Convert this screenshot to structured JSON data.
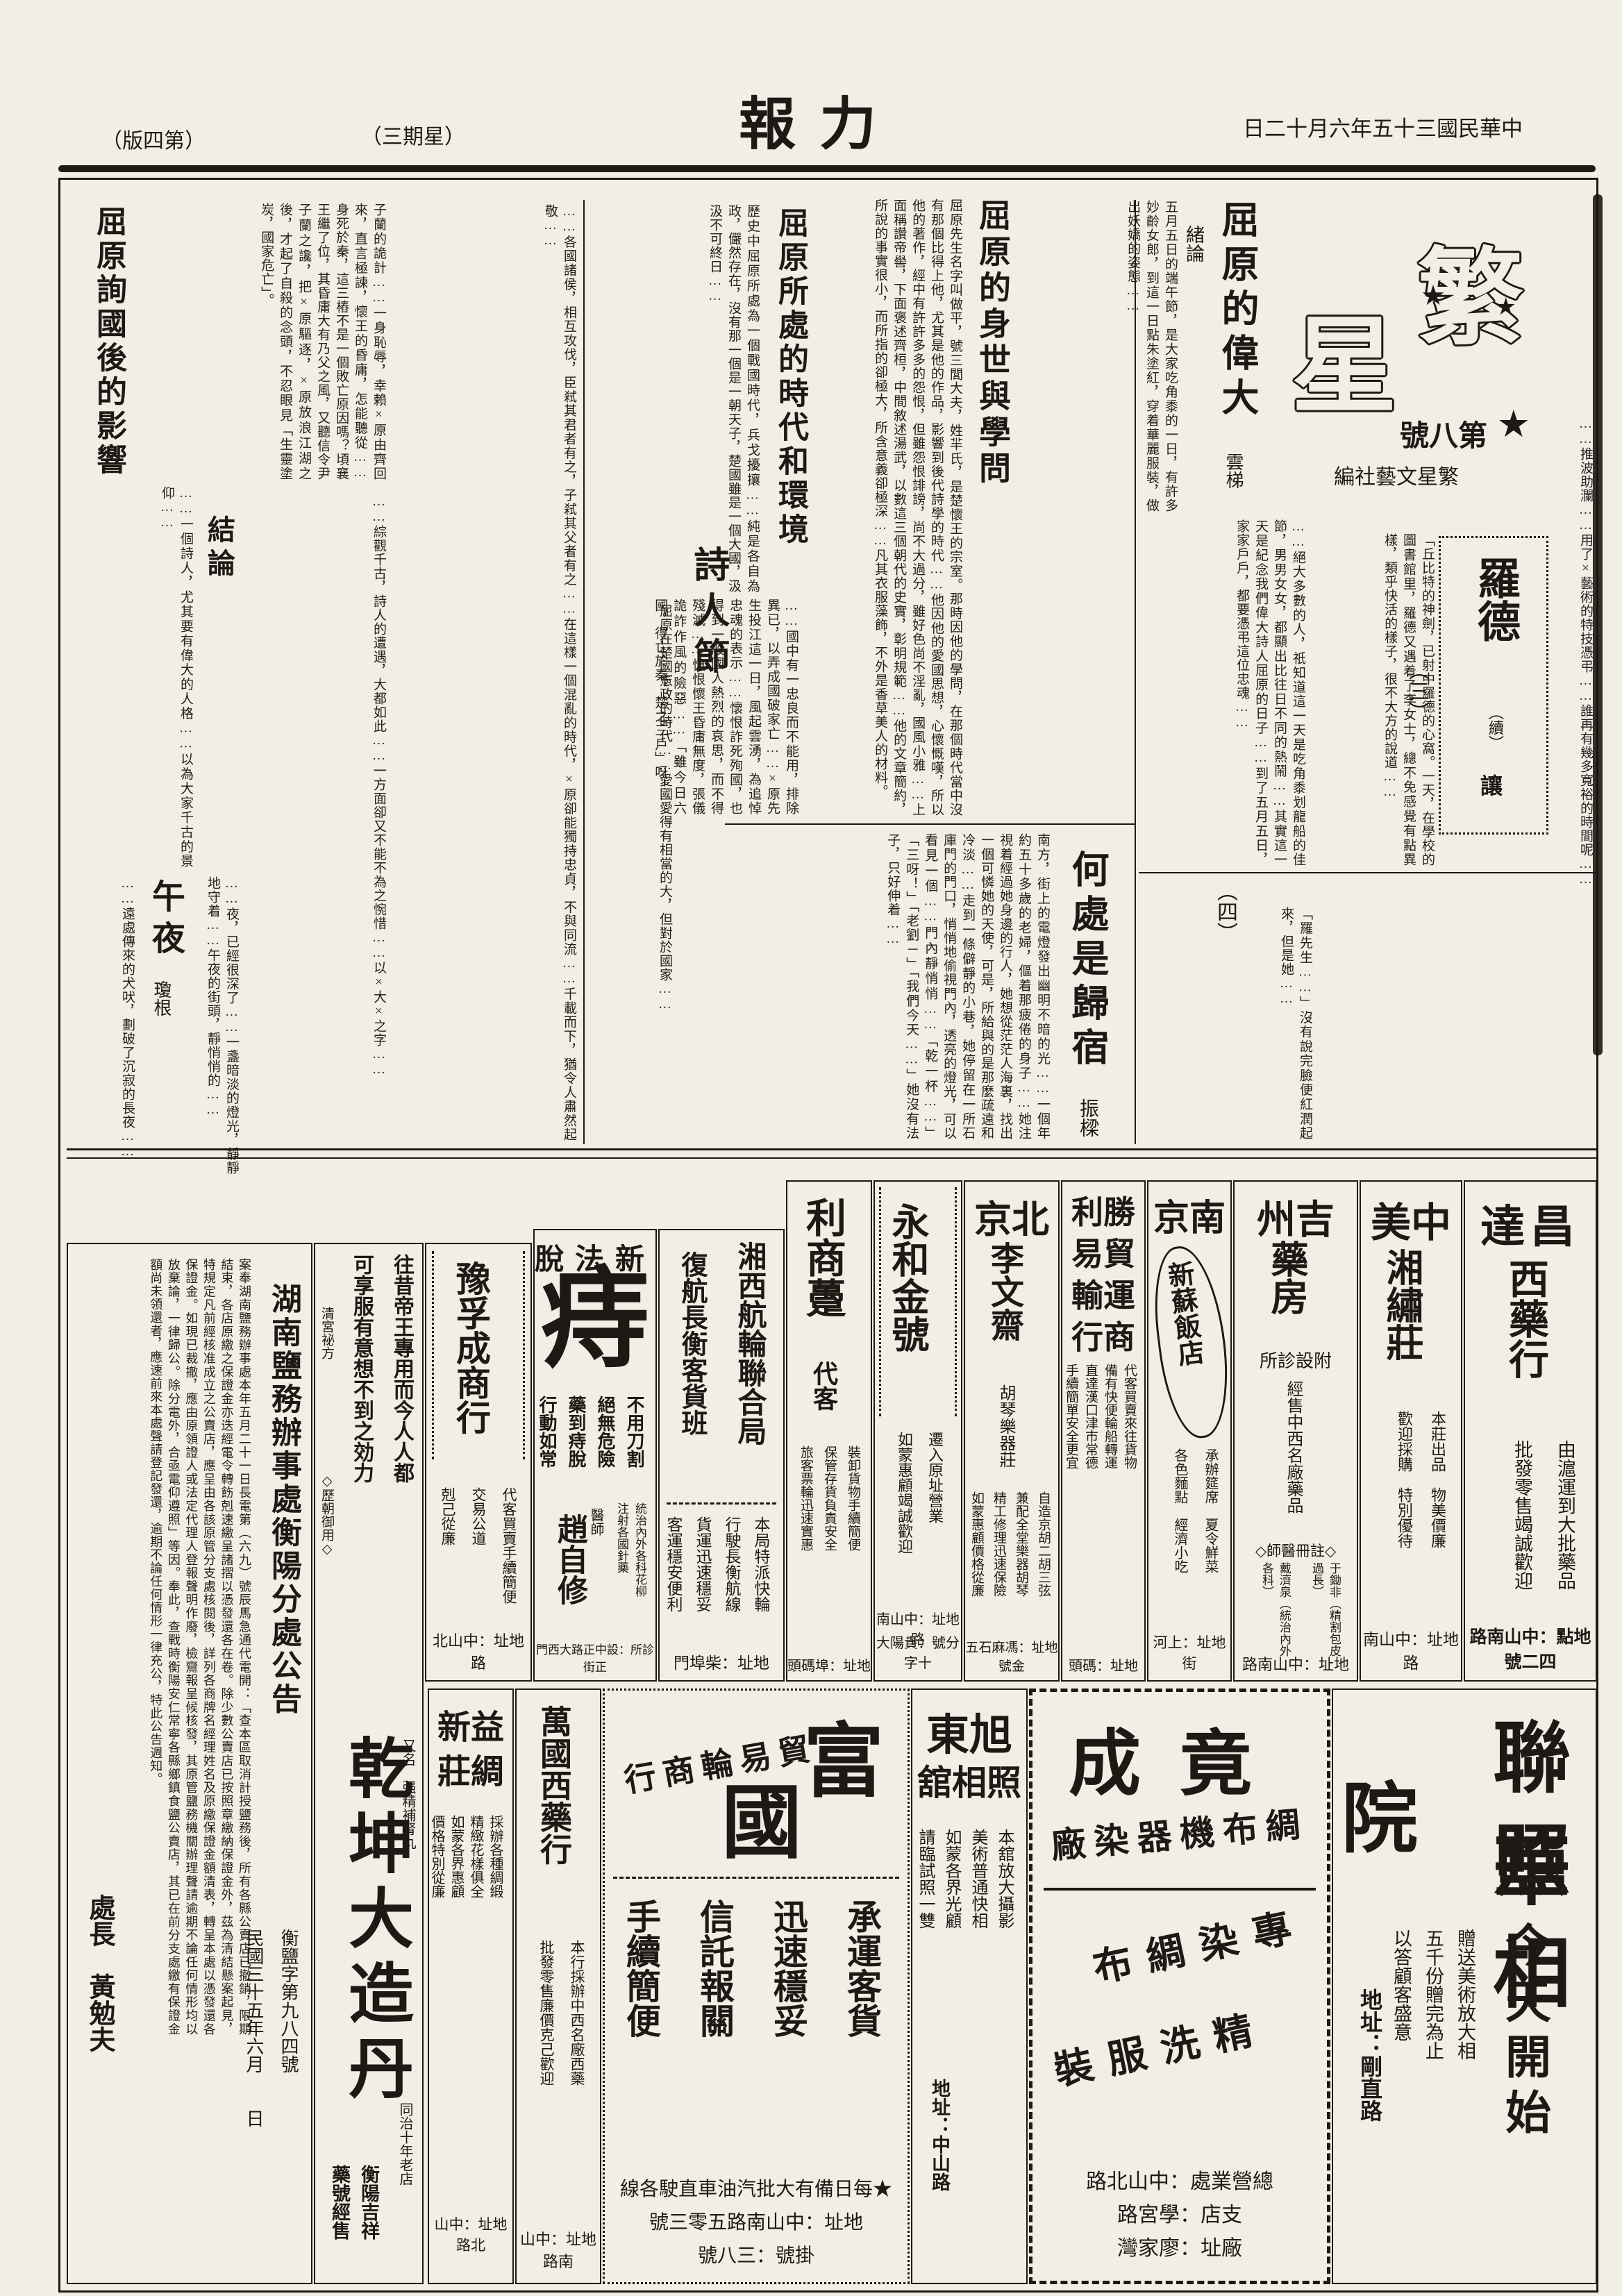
{
  "colors": {
    "paper": "#f1eee6",
    "ink": "#1d1a15"
  },
  "head": {
    "date": "中華民國三十五年六月十二日",
    "title": "力報",
    "weekday": "（星期三）",
    "edition": "（第四版）"
  },
  "supp": {
    "logo_char_1": "繁",
    "logo_char_2": "星",
    "star": "★",
    "issue": "第八號",
    "editor": "繁星文藝社編"
  },
  "art": {
    "weida": {
      "section": "緒論",
      "title": "屈原的偉大",
      "author": "雲梯",
      "body": "五月五日的端午節，是大家吃角黍的一日，有許多妙齡女郎，到這一日點朱塗紅，穿着華麗服裝，做出妖嬌的姿態……",
      "body2": "……絕大多數的人，祇知道這一天是吃角黍划龍船的佳節，男男女女，都顯出比往日不同的熱鬧……其實這一天是紀念我們偉大詩人屈原的日子……到了五月五日，家家戶戶，都要憑弔這位忠魂……"
    },
    "luode": {
      "title": "羅德",
      "cont": "（續）",
      "author": "讓",
      "part3": "（三）",
      "part4": "（四）",
      "body": "「丘比特的神劍，已射中羅德的心窩。一天，在學校的圖書館里，羅德又遇着了李女士，總不免感覺有點異樣，類乎快活的樣子，很不大方的說道……",
      "body2": "「羅先生……」沒有說完臉便紅潤起來，但是她……"
    },
    "shenshi": {
      "title": "屈原的身世與學問",
      "body": "屈原先生名字叫做平，號三閭大夫，姓羋氏，是楚懷王的宗室。那時因他的學問，在那個時代當中沒有那個比得上他，尤其是他的作品，影響到後代詩學的時代……他因他的愛國思想，心懷慨嘆，所以他的著作，經中有許許多多的怨恨，但雖怨恨誹謗，尚不大過分，雖好色尚不淫亂，國風小雅……上面稱讚帝嚳，下面褒述齊桓，中間敘述湯武，以數這三個朝代的史實，彰明規範……他的文章簡約，所說的事實很小，而所指的卻極大，所含意義卻極深……凡其衣服藻飾，不外是香草美人的材料。"
    },
    "shidai": {
      "title": "屈原所處的時代和環境",
      "body": "歷史中屈原所處為一個戰國時代，兵戈擾攘……純是各自為政，儼然存在，沒有那一個是一朝天子，楚國雖是一個大國，汲汲不可終日……"
    },
    "shiren": {
      "title": "詩人節",
      "body": "屈原在楚國憲政的時代……愛國愛得有相當的大，但對於國家……"
    },
    "zhonglun": {
      "body": "……國中有一忠良而不能用，排除異已，以弄成國破家亡……×原先生投江這一日，風起雲湧，為追悼忠魂的表示……懷恨詐死殉國，也得到一般國人熱烈的哀思，而不得殘滅……慎恨懷王昏庸無度，張儀詭詐作風的險惡……「雖今日六國，得亡於秦，楚之三戶」呀！"
    },
    "yingxiang": {
      "title": "屈原詢國後的影響",
      "body": "子蘭的詭計……一身恥辱，幸賴×原由齊回來，直言極諫，懷王的昏庸，怎能聽從……身死於秦，這三樁不是一個敗亡原因嗎？頃襄王繼了位，其昏庸大有乃父之風，又聽信令尹子蘭之讒，把×原驅逐，×原放浪江湖之後，才起了自殺的念頭，不忍眼見「生靈塗炭，國家危亡」。"
    },
    "jielun": {
      "title": "結論",
      "body": "……一個詩人，尤其要有偉大的人格……以為大家千古的景仰……"
    },
    "guisu": {
      "title": "何處是歸宿",
      "author": "振樑",
      "body": "南方，街上的電燈發出幽明不暗的光……一個年約五十多歲的老婦，傴着那疲倦的身子……她注視着經過她身邊的行人，她想從茫茫人海裏，找出一個可憐她的天使，可是，所給與的是那麼疏遠和冷淡……走到一條僻靜的小巷，她停留在一所石庫門的門口，悄悄地偷視門內，透亮的燈光，可以看見一個……門內靜悄悄……「乾一杯……」「三呀！」「老劉－」「我們今天……」她沒有法子，只好伸着……"
    },
    "wuye": {
      "title": "午夜",
      "author": "瓊根",
      "body": "……夜，已經很深了……一盞暗淡的燈光，靜靜地守着……午夜的街頭，靜悄悄的……",
      "body2": "……遠處傳來的犬吠，劃破了沉寂的長夜……"
    },
    "fillers": {
      "right": "……推波助瀾……用了×藝術的特技憑弔……誰再有幾多寬裕的時間呢……",
      "mid": "……各國諸侯，相互攻伐，臣弒其君者有之，子弒其父者有之……在這樣一個混亂的時代，×原卻能獨持忠貞，不與同流……千載而下，猶令人肅然起敬……",
      "left": "……綜觀千古，詩人的遭遇，大都如此……一方面卻又不能不為之惋惜……以×大×之字……"
    }
  },
  "ads1": {
    "changda": {
      "name_top": "昌達",
      "name_v": "西藥行",
      "line1": "由滬運到大批藥品",
      "line2": "批發零售竭誠歡迎",
      "addr": "地點：中山南路四二號"
    },
    "zhongmei": {
      "name_top": "中美",
      "name_v": "湘繡莊",
      "line1": "本莊出品　物美價廉",
      "line2": "歡迎採購　特別優待",
      "addr": "地址：中山南路"
    },
    "jizhou": {
      "name_top": "吉州",
      "name_v": "藥房",
      "sub": "附設診所",
      "line1": "經售中西名廠藥品",
      "doc_label": "◇註冊醫師◇",
      "doc1": "戴濟泉（統治內外各科）",
      "doc2": "于鋤非（精割包皮過長）",
      "addr": "地址：中山南路"
    },
    "nanjing": {
      "name_top": "南京",
      "bubble": "新蘇飯店",
      "line1": "承辦筵席　夏令鮮菜",
      "line2": "各色麵點　經濟小吃",
      "addr": "地址：上河街"
    },
    "shengli": {
      "l1": "勝利",
      "l2": "貿易",
      "l3": "運輸",
      "l4": "商行",
      "line1": "代客買賣來往貨物",
      "line2": "備有快便輪船轉運",
      "line3": "直達漢口津市常德",
      "line4": "手續簡單安全更宜",
      "addr": "地址：碼頭"
    },
    "liwenzhai": {
      "name_top": "北京",
      "name_v": "李文齋",
      "sub": "胡琴樂器莊",
      "line1": "自造京胡二胡三弦",
      "line2": "兼配全堂樂器胡琴",
      "line3": "精工修理迅速保險",
      "line4": "如蒙惠顧價格從廉",
      "addr": "地址：馮麻石五金號"
    },
    "yonghe": {
      "name_v": "永和金號",
      "line1": "遷入原址營業",
      "line2": "如蒙惠顧竭誠歡迎",
      "addr": "地址：中山南路",
      "branch": "分號：貴陽大十字"
    },
    "lishang": {
      "name_v": "利商躉",
      "sub": "代客",
      "line1": "裝卸貨物手續簡便",
      "line2": "保管存貨負責安全",
      "line3": "旅客票輪迅速實惠",
      "addr": "地址：埠碼頭"
    },
    "xiangxi": {
      "name_v": "湘西航輪聯合局",
      "sub_v": "復航長衡客貨班",
      "line1": "本局特派快輪",
      "line2": "行駛長衡航線",
      "line3": "貨運迅速穩妥",
      "line4": "客運穩安便利",
      "addr": "地址：柴埠門"
    },
    "tuozhi": {
      "name_top": "新法脫",
      "big": "痔",
      "line1": "不用刀割",
      "line2": "絕無危險",
      "line3": "藥到痔脫",
      "line4": "行動如常",
      "doc_label": "醫師",
      "doctor": "趙自修",
      "extra1": "統治內外各科花柳",
      "extra2": "注射各國針藥",
      "clinic": "診所：設中正路大西門正街"
    },
    "yufucheng": {
      "name_v": "豫孚成商行",
      "line1": "代客買賣手續簡便",
      "line2": "交易公道",
      "line3": "剋己從廉",
      "addr": "地址：中山北路"
    },
    "qiankun": {
      "lead1": "往昔帝王專用而今人人都",
      "lead2": "可享服有意想不到之効力",
      "sub1": "清宮祕方",
      "sub2": "◇歷朝御用◇",
      "name": "乾坤大造丹",
      "alias": "又名　强精補腎丸",
      "note": "同治十年老店",
      "store1": "衡陽吉祥",
      "store2": "藥號經售"
    }
  },
  "notice": {
    "title": "湖南鹽務辦事處衡陽分處公告",
    "body": "案奉湖南鹽務辦事處本年五月二十一日長電第（六九）號辰馬急通代電開：「查本區取消計授鹽務後，所有各縣公賣店已撤銷，限期結束，各店原繳之保證金亦迭經電令轉飭剋速繳呈諸摺以憑發還各在卷。除少數公賣店已按照章繳納保證金外，茲為清結懸案起見，特規定凡前經核准成立之公賣店，應呈由各該原管分支處核閱後，詳列各商牌名經理姓名及原繳保證金額清表，轉呈本處以憑發還各保證金。如現已裁撤，應由原領證人或法定代理人登報聲明作廢，檢齎報呈候核發，其原管鹽務機關辦理聲請逾期不論任何情形均以放棄論，一律歸公。除分電外，合亟電仰遵照」等因。奉此，查戰時衡陽安仁常寧各縣鄉鎮食鹽公賣店，其已在前分支處繳有保證金額尚未領還者，應速前來本處聲請登記發還，逾期不論任何情形一律充公，特此公告週知。",
    "date_line": "民國三十五年六月　　日",
    "doc_no": "衡鹽字第九八四號",
    "signer_title": "處長",
    "signer": "黃勉夫"
  },
  "ads2": {
    "lianhua": {
      "l1": "聯華",
      "l2": "照相",
      "l3": "院",
      "slogan": "今天開始",
      "line1": "贈送美術放大相",
      "line2": "五千份贈完為止",
      "line3": "以答顧客盛意",
      "addr": "地址：剛直路"
    },
    "jingcheng": {
      "name": "竟成",
      "sub": "綢布機器染廠",
      "svc1": "專染綢布",
      "svc2": "精洗服裝",
      "f1": "總營業處：中山北路",
      "f2": "支店：學宮路",
      "f3": "廠址：廖家灣"
    },
    "xudong": {
      "l1": "旭東",
      "l2": "照相舘",
      "line1": "本舘放大攝影",
      "line2": "美術普通快相",
      "line3": "如蒙各界光顧",
      "line4": "請臨試照一雙",
      "addr": "地址：中山路"
    },
    "fuguo": {
      "c1": "富",
      "c2": "國",
      "sub": "貿易輪商行",
      "svc1": "承運客貨",
      "svc2": "迅速穩妥",
      "svc3": "信託報關",
      "svc4": "手續簡便",
      "star_line": "★每日備有大批汽油車直駛各線",
      "addr": "地址：中山南路五零三號",
      "reg": "掛號：三八號"
    },
    "wanguo": {
      "name_v": "萬國西藥行",
      "line1": "本行採辦中西名廠西藥",
      "line2": "批發零售廉價克己歡迎",
      "addr": "地址：中山南路"
    },
    "yixin": {
      "l1": "益新",
      "l2": "綢莊",
      "line1": "採辦各種綢緞",
      "line2": "精緻花樣俱全",
      "line3": "如蒙各界惠顧",
      "line4": "價格特別從廉",
      "addr": "地址：中山北路"
    }
  }
}
